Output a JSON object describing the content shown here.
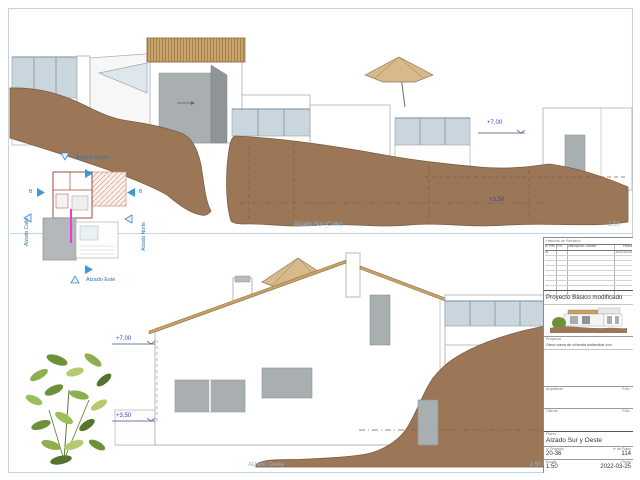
{
  "views": {
    "top": {
      "title": "Alzado Sur (Calle)",
      "scale": "1:50",
      "level_upper": "+7,00",
      "level_lower": "+3,50"
    },
    "bottom": {
      "title": "Alzado Oeste",
      "scale": "1:50",
      "level_upper": "+7,00",
      "level_lower": "+3,50"
    }
  },
  "keyplan": {
    "west_label": "Alzado Oeste",
    "east_label": "Alzado Este",
    "north_label": "Alzado Norte",
    "street_label": "Alzado Calle",
    "section_left": "B",
    "section_right": "B"
  },
  "titleblock": {
    "revision_title": "Historial de Revisión",
    "columns": [
      "Nº Rev",
      "Por",
      "Descripción Cambio",
      "Fecha"
    ],
    "first_row": {
      "num": "01",
      "by": "",
      "desc": "",
      "date": "2022-03-25"
    },
    "project_title": "Proyecto Básico modificado",
    "project_label": "Proyecto",
    "project_description": "Obra nueva de vivienda unifamiliar con",
    "architect_label": "Arquitecto",
    "architect_sign": "Fdo.:",
    "client_label": "Cliente",
    "client_sign": "Fdo.:",
    "plan_label": "Plano:",
    "plan_name": "Alzado Sur y Oeste",
    "project_no_label": "nº Proyecto",
    "project_no": "20-36",
    "plan_no_label": "nº de Plano",
    "plan_no": "114",
    "scale_label": "Escala",
    "scale_value": "1:50",
    "date_label": "Fecha",
    "date_value": "2022-03-25"
  },
  "colors": {
    "terrain": "#9b7758",
    "wood": "#c9a165",
    "glass": "#c9d6dd",
    "annotation_blue": "#2a52be",
    "title_blue": "#8fb8da",
    "magenta": "#e83fd8"
  }
}
